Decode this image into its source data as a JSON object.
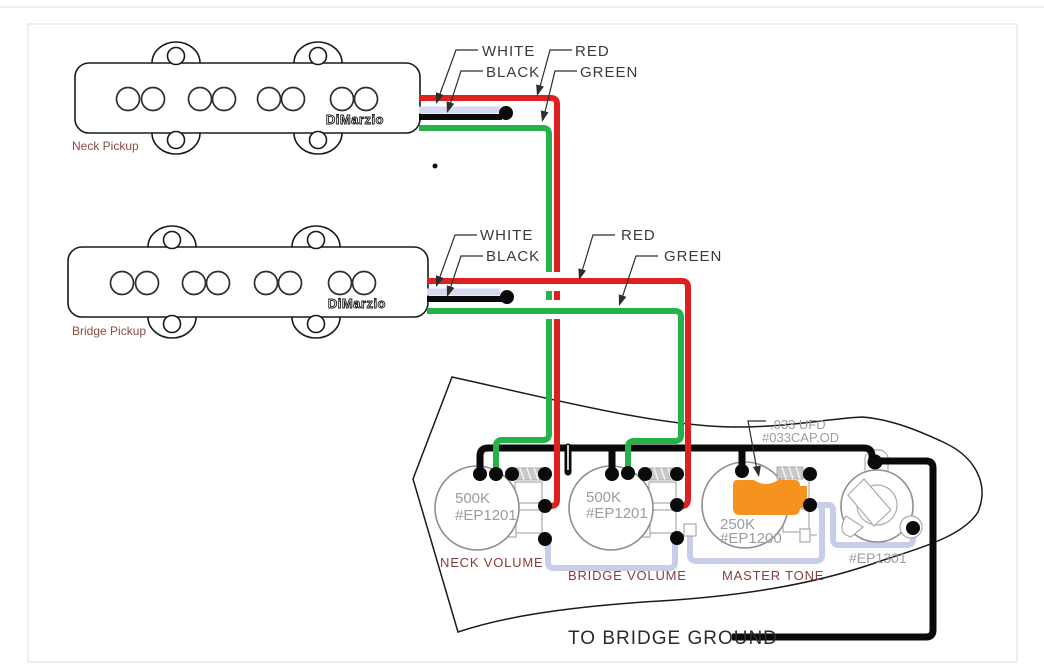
{
  "wire_labels": {
    "white": "WHITE",
    "black": "BLACK",
    "red": "RED",
    "green": "GREEN"
  },
  "pickups": {
    "neck": {
      "label": "Neck Pickup",
      "brand": "DiMarzio"
    },
    "bridge": {
      "label": "Bridge Pickup",
      "brand": "DiMarzio"
    }
  },
  "controls": {
    "neck_volume": {
      "value": "500K",
      "part": "#EP1201",
      "label": "NECK VOLUME"
    },
    "bridge_volume": {
      "value": "500K",
      "part": "#EP1201",
      "label": "BRIDGE VOLUME"
    },
    "master_tone": {
      "value": "250K",
      "part": "#EP1200",
      "label": "MASTER TONE"
    },
    "capacitor": {
      "value": ".033 UFD",
      "part": "#033CAP.OD"
    },
    "jack": {
      "part": "#EP1301"
    }
  },
  "notes": {
    "bridge_ground": "TO BRIDGE GROUND"
  },
  "colors": {
    "wire_red": "#dd2121",
    "wire_green": "#26b24b",
    "wire_black": "#0a0a0a",
    "wire_white": "#d6d9ef",
    "connection_wire": "#c8cde9",
    "capacitor_orange": "#f6921e",
    "part_text_gray": "#9c9c9c",
    "control_label_maroon": "#8a3c3c",
    "pickup_label_brown": "#8b4a42"
  }
}
